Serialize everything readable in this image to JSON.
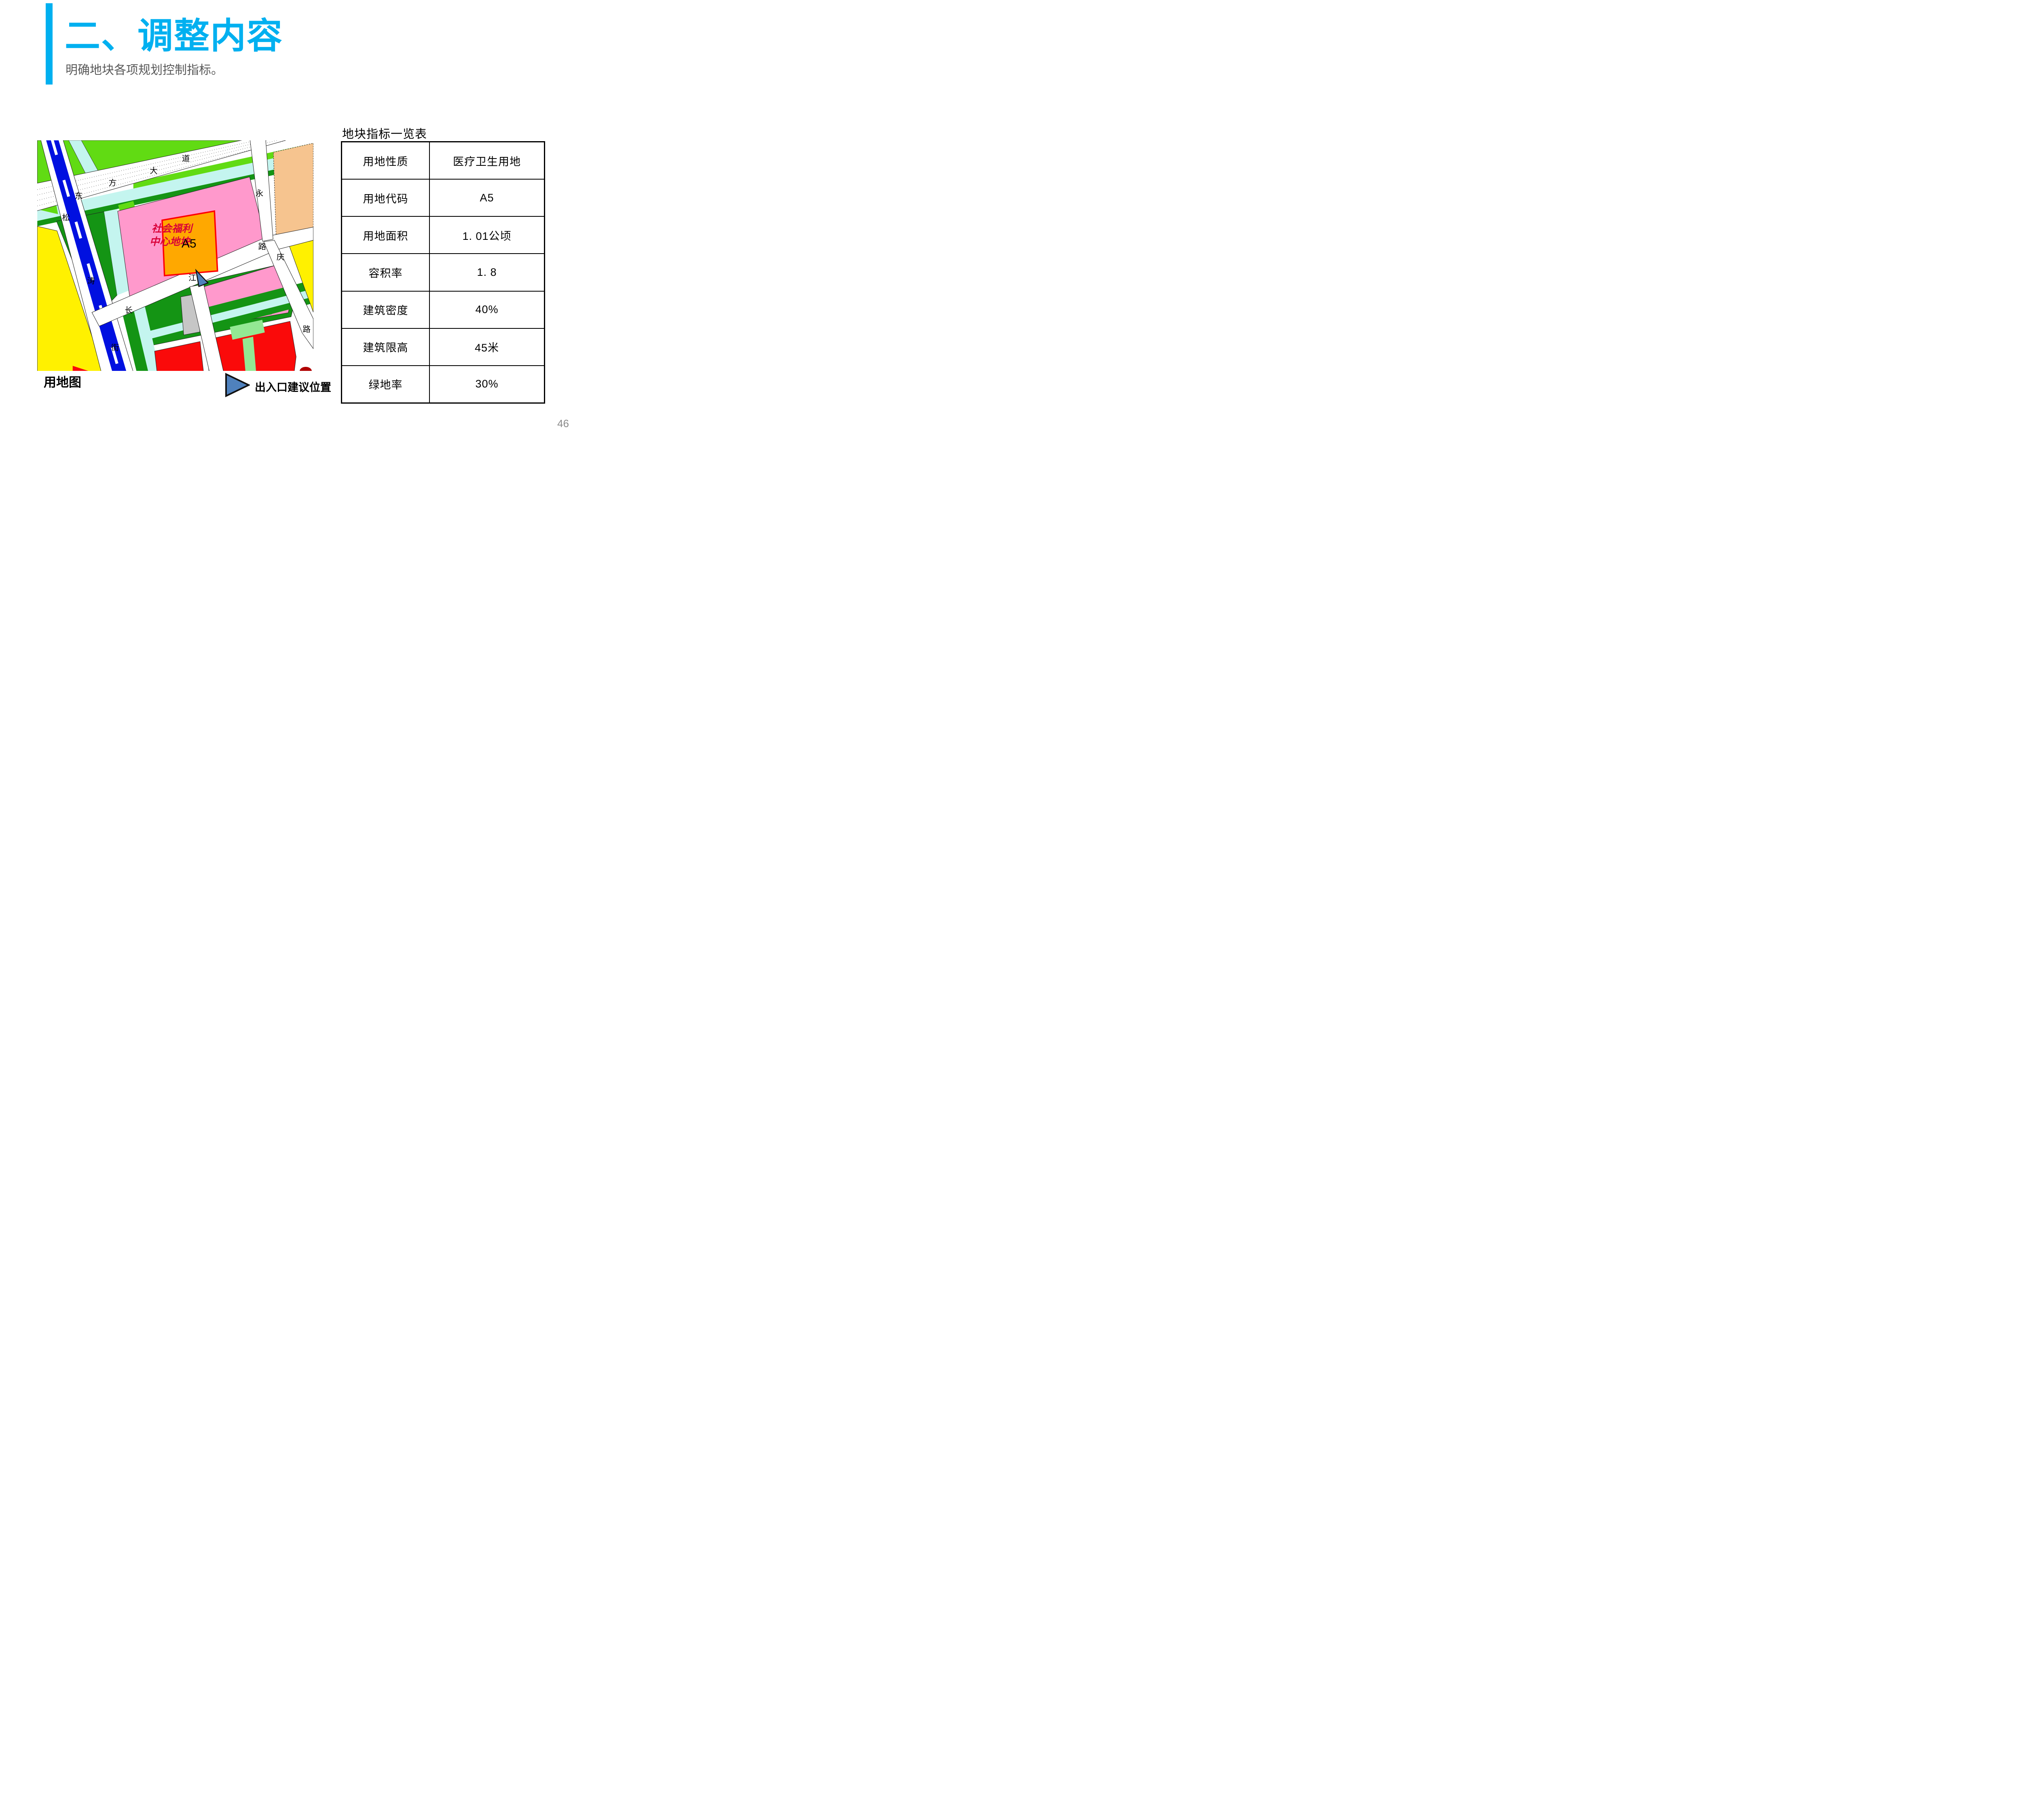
{
  "slide": {
    "title": "二、调整内容",
    "subtitle": "明确地块各项规划控制指标。",
    "page_number": "46",
    "accent_color": "#00B0F0"
  },
  "map": {
    "caption": "用地图",
    "plot_label_line1": "社会福利",
    "plot_label_line2": "中心地块",
    "plot_code": "A5",
    "roads": {
      "dongfang_dadao": [
        "东",
        "方",
        "大",
        "道"
      ],
      "songtao_jie": [
        "松",
        "涛",
        "街"
      ],
      "changjiang_lu": [
        "长",
        "江",
        "路"
      ],
      "yongqing_lu": [
        "永",
        "庆",
        "路"
      ]
    },
    "legend": {
      "label": "出入口建议位置",
      "marker_color": "#4F81BD"
    },
    "colors": {
      "lime_green": "#61DB13",
      "dark_green": "#149414",
      "pale_cyan": "#C4F5EF",
      "pink": "#FF99CC",
      "orange": "#FFA800",
      "plot_border_red": "#FF0000",
      "peach": "#F6C48F",
      "yellow": "#FFF100",
      "red": "#FA0A0A",
      "light_green": "#93E893",
      "gray": "#C6C6C6",
      "road_blue": "#0010E0",
      "plot_text_red": "#D90038"
    }
  },
  "table": {
    "title": "地块指标一览表",
    "rows": [
      {
        "label": "用地性质",
        "value": "医疗卫生用地"
      },
      {
        "label": "用地代码",
        "value": "A5"
      },
      {
        "label": "用地面积",
        "value": "1. 01公顷"
      },
      {
        "label": "容积率",
        "value": "1. 8"
      },
      {
        "label": "建筑密度",
        "value": "40%"
      },
      {
        "label": "建筑限高",
        "value": "45米"
      },
      {
        "label": "绿地率",
        "value": "30%"
      }
    ]
  }
}
